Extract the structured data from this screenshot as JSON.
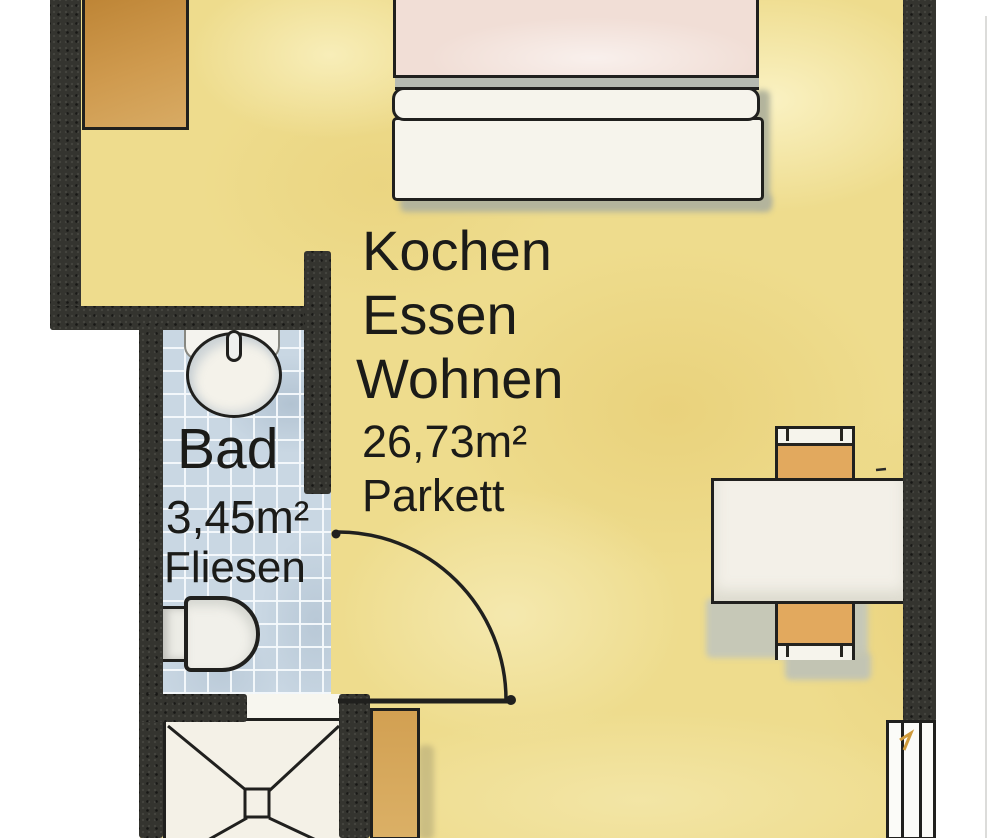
{
  "plan": {
    "rooms": {
      "main": {
        "name_lines": [
          "Kochen",
          "Essen",
          "Wohnen"
        ],
        "area": "26,73m²",
        "flooring": "Parkett"
      },
      "bath": {
        "name": "Bad",
        "area": "3,45m²",
        "flooring": "Fliesen"
      }
    },
    "fixtures": {
      "bed": "double-bed",
      "wardrobe": "wardrobe-unit",
      "washbasin": "washbasin-with-tap",
      "toilet": "toilet",
      "shower": "shower-tray-with-drain",
      "table": "dining-table",
      "chairs": "two-chairs",
      "door": "door-90deg-swing",
      "window": "balcony-window",
      "kitchen_unit": "kitchen-unit"
    },
    "colors": {
      "floor": "#eedc8d",
      "wall": "#34342f",
      "tiles": "#c9d7e3",
      "wood_furniture": "#d2a052",
      "mattress": "#f1ded6",
      "white_furniture": "#f6f4ec",
      "outline": "#20201e",
      "shadow": "#b3b49c",
      "text": "#1b1b18"
    }
  }
}
